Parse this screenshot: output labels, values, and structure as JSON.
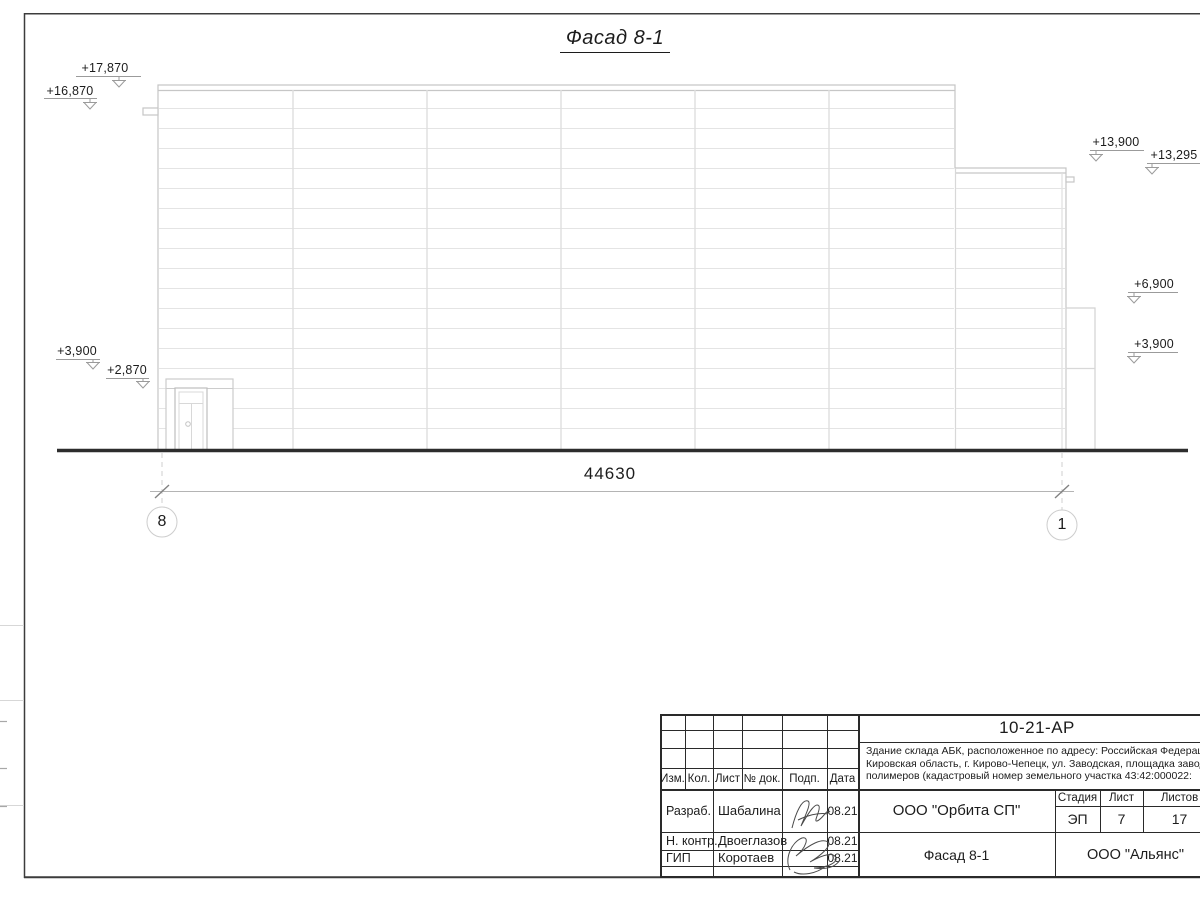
{
  "sheet": {
    "title": "Фасад 8-1",
    "dimension_total": "44630",
    "axis_left_label": "8",
    "axis_right_label": "1"
  },
  "elevation_marks": {
    "left": [
      {
        "value": "+17,870"
      },
      {
        "value": "+16,870"
      },
      {
        "value": "+3,900"
      },
      {
        "value": "+2,870"
      }
    ],
    "right": [
      {
        "value": "+13,900"
      },
      {
        "value": "+13,295"
      },
      {
        "value": "+6,900"
      },
      {
        "value": "+3,900"
      }
    ]
  },
  "title_block": {
    "doc_number": "10-21-АР",
    "description": [
      "Здание склада АБК, расположенное по адресу: Российская Федерация,",
      "Кировская область, г. Кирово-Чепецк, ул. Заводская, площадка завода",
      "полимеров (кадастровый номер земельного участка 43:42:000022:"
    ],
    "col_headers": {
      "izm": "Изм.",
      "kol": "Кол.",
      "list": "Лист",
      "doc": "№ док.",
      "podp": "Подп.",
      "data": "Дата"
    },
    "roles": [
      {
        "role": "Разраб.",
        "name": "Шабалина",
        "date": "08.21"
      },
      {
        "role": "Н. контр.",
        "name": "Двоеглазов",
        "date": "08.21"
      },
      {
        "role": "ГИП",
        "name": "Коротаев",
        "date": "08.21"
      }
    ],
    "stage": {
      "stage_header": "Стадия",
      "sheet_header": "Лист",
      "sheets_header": "Листов",
      "stage_value": "ЭП",
      "sheet_value": "7",
      "sheets_value": "17"
    },
    "company": "ООО \"Орбита СП\"",
    "drawing_title": "Фасад 8-1",
    "contractor": "ООО \"Альянс\""
  },
  "colors": {
    "outline": "#c6c6c6",
    "panel_joint": "#e4e4e4",
    "ground": "#2d2d2d",
    "text": "#1c1c1c",
    "title_block_line": "#2a2a2a"
  }
}
